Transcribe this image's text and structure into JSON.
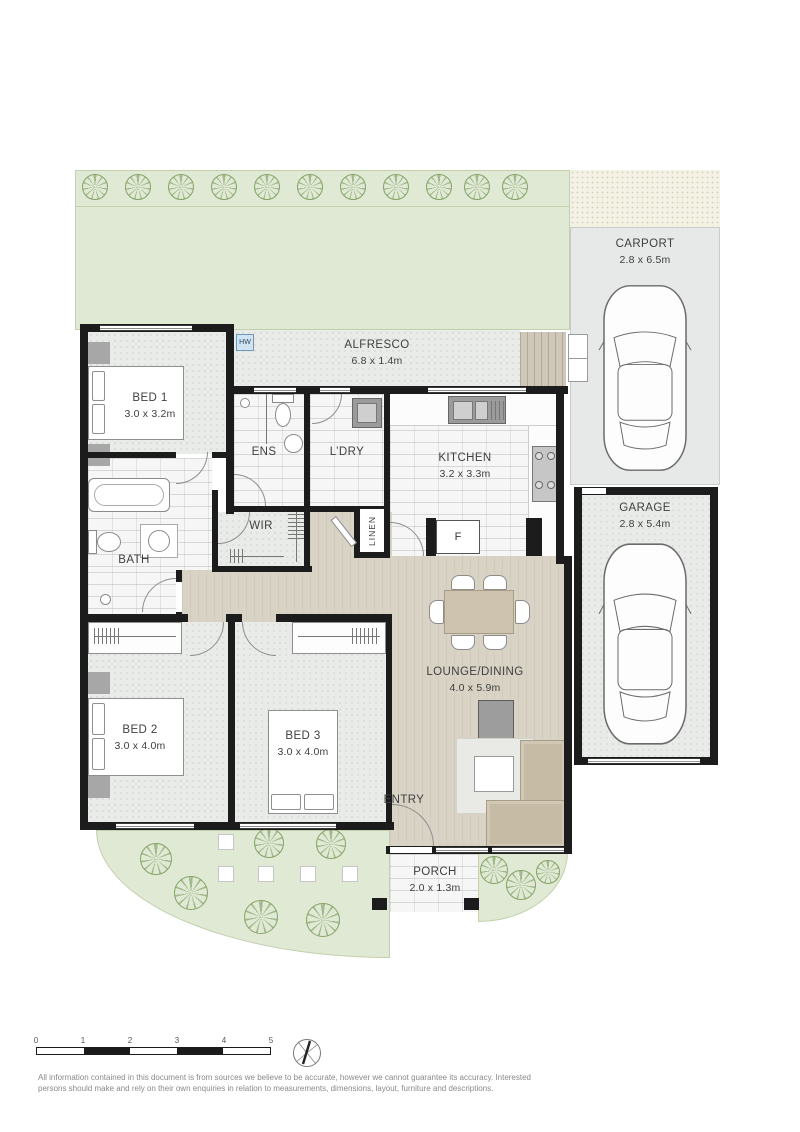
{
  "rooms": {
    "bed1": {
      "label": "BED 1",
      "dims": "3.0 x 3.2m"
    },
    "bed2": {
      "label": "BED 2",
      "dims": "3.0 x 4.0m"
    },
    "bed3": {
      "label": "BED 3",
      "dims": "3.0 x 4.0m"
    },
    "kitchen": {
      "label": "KITCHEN",
      "dims": "3.2 x 3.3m"
    },
    "lounge_dining": {
      "label": "LOUNGE/DINING",
      "dims": "4.0 x 5.9m"
    },
    "alfresco": {
      "label": "ALFRESCO",
      "dims": "6.8 x 1.4m"
    },
    "carport": {
      "label": "CARPORT",
      "dims": "2.8 x 6.5m"
    },
    "garage": {
      "label": "GARAGE",
      "dims": "2.8 x 5.4m"
    },
    "porch": {
      "label": "PORCH",
      "dims": "2.0 x 1.3m"
    },
    "ens": {
      "label": "ENS"
    },
    "laundry": {
      "label": "L’DRY"
    },
    "bath": {
      "label": "BATH"
    },
    "wir": {
      "label": "WIR"
    },
    "linen": {
      "label": "LINEN"
    },
    "entry": {
      "label": "ENTRY"
    },
    "hot_water": {
      "label": "HW"
    },
    "fridge": {
      "label": "F"
    }
  },
  "scale_bar": {
    "ticks": [
      "0",
      "1",
      "2",
      "3",
      "4",
      "5"
    ]
  },
  "footer": {
    "disclaimer_line1": "All information contained in this document is from sources we believe to be accurate, however we cannot guarantee its accuracy. Interested",
    "disclaimer_line2": "persons should make and rely on their own enquiries in relation to measurements, dimensions, layout, furniture and descriptions."
  },
  "colors": {
    "garden": "#e0e9d3",
    "floor": "#e9ebe9",
    "hall": "#d9d3c5",
    "wall": "#1c1c1c",
    "tile": "#f5f6f5",
    "hot_water": "#cfe3f2",
    "furniture": "#c6bba4"
  }
}
